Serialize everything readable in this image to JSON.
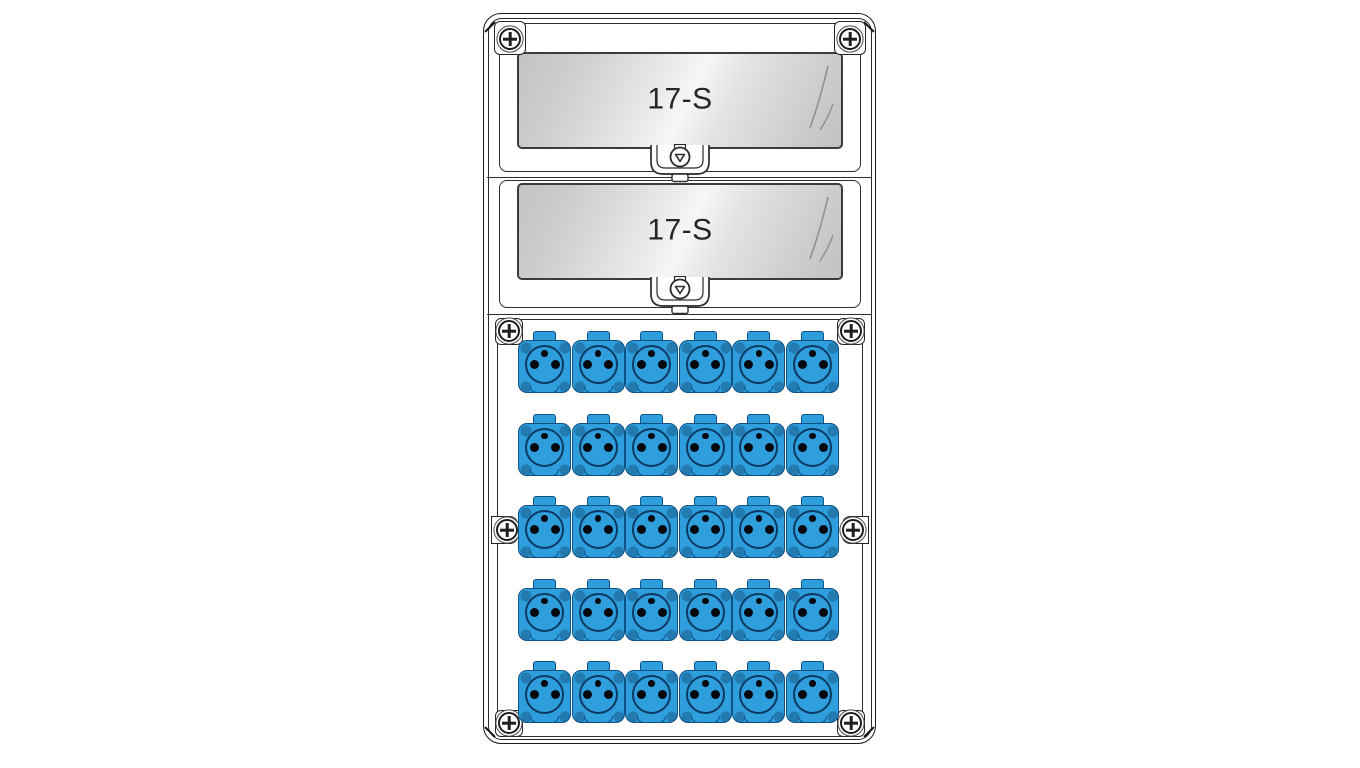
{
  "device": {
    "kind": "power-distribution-board-diagram",
    "windows": [
      {
        "label": "17-S"
      },
      {
        "label": "17-S"
      }
    ],
    "sockets": {
      "rows": 5,
      "cols": 6,
      "count": 30,
      "style": "type-e-round-socket"
    },
    "colors": {
      "socket_blue": "#2e9edd",
      "socket_edge": "#0f5085",
      "socket_hole": "#05080d",
      "outline": "#1b1b1b",
      "glass_light": "#f6f6f6",
      "glass_dark": "#c3c3c3",
      "label_text": "#262626"
    }
  }
}
